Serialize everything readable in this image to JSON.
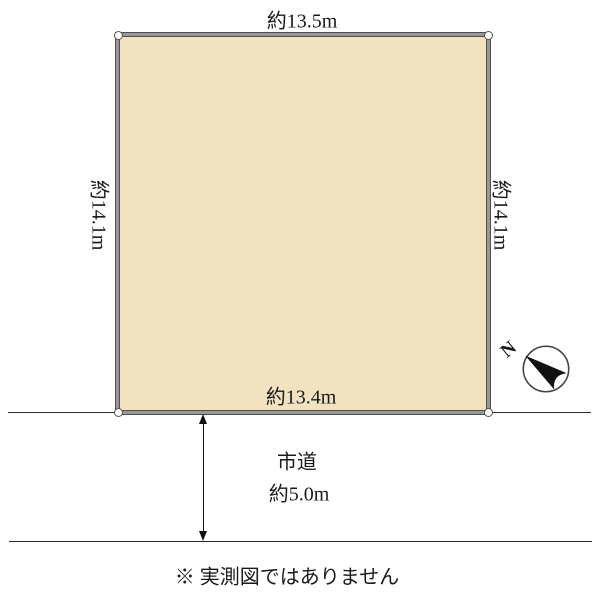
{
  "plot": {
    "top_dim": "約13.5m",
    "left_dim": "約14.1m",
    "right_dim": "約14.1m",
    "bottom_dim": "約13.4m",
    "fill_color": "#f1e3c0",
    "border_color": "#989898"
  },
  "road": {
    "name": "市道",
    "width_label": "約5.0m"
  },
  "compass": {
    "north_label": "N"
  },
  "footer": {
    "disclaimer": "※ 実測図ではありません"
  }
}
